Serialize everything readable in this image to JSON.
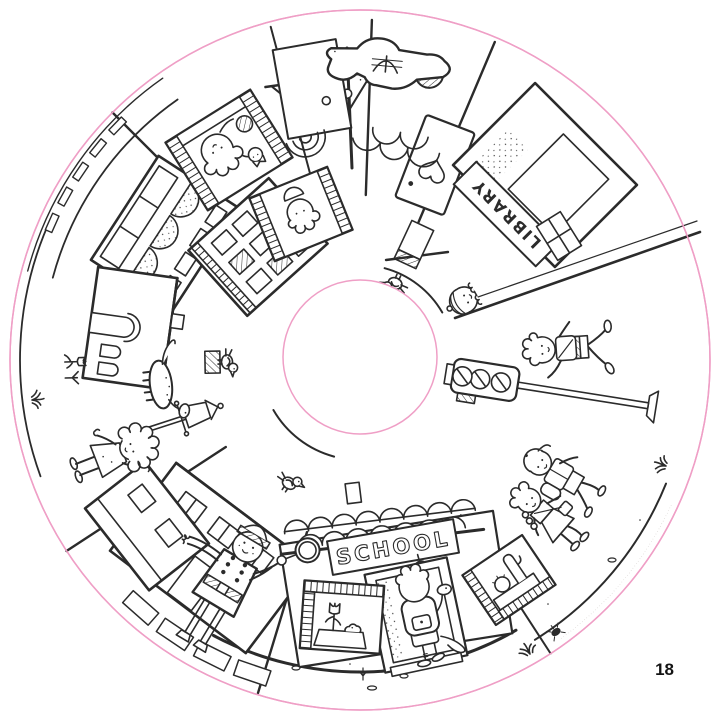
{
  "document": {
    "type": "circular coloring-book page",
    "page_number": "18"
  },
  "scene": {
    "description": "round town scene: school, library, police officer, children, dinosaurs",
    "labels": {
      "school_sign": "SCHOOL",
      "library_sign": "LIBRARY"
    },
    "fine_print": "····························································",
    "colors": {
      "outline_pink": "#ef9fc6",
      "ink": "#2b2b2b",
      "fine_print_gray": "#b5aea8",
      "paper": "#ffffff"
    },
    "elements": [
      "scooter-top-view",
      "heart-door",
      "library",
      "school",
      "traffic-light",
      "street-lamp",
      "police-officer",
      "running-boy",
      "walking-kids",
      "curly-haired-girl",
      "girl-peeking",
      "schoolboy-with-dinosaur",
      "dinosaur",
      "birds",
      "windows-with-children",
      "shops",
      "apartment-building",
      "arched-house",
      "crosswalk",
      "bell",
      "tulip-window",
      "cactus-window"
    ]
  }
}
